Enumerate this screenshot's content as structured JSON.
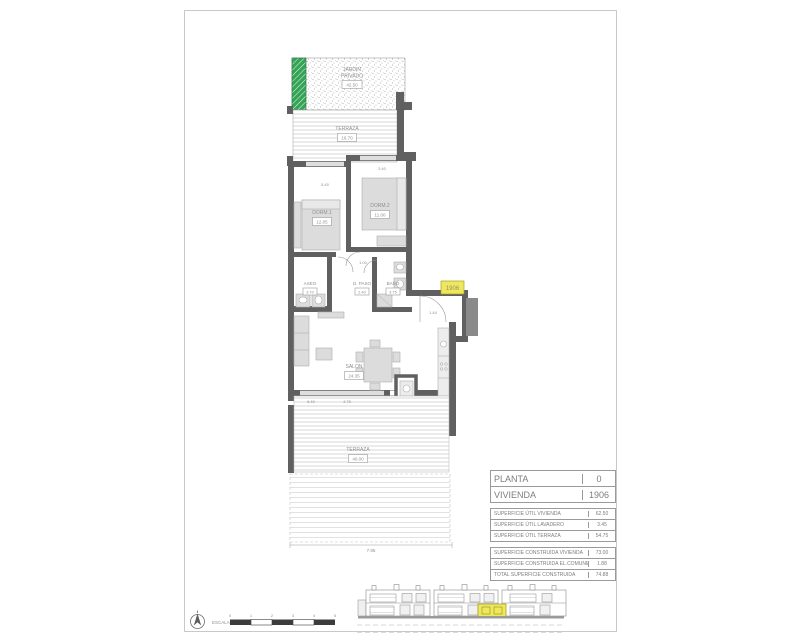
{
  "plan": {
    "jardin": {
      "line1": "JARDIN",
      "line2": "PRIVADO",
      "value": "42.50"
    },
    "terraza_top": {
      "label": "TERRAZA",
      "value": "16.70"
    },
    "dorm1": {
      "label": "DORM.1",
      "value": "12.05"
    },
    "dorm2": {
      "label": "DORM.2",
      "value": "11.00"
    },
    "aseo": {
      "label": "ASEO",
      "value": "3.70"
    },
    "paso": {
      "label": "D. PASO",
      "value": "2.40"
    },
    "bano": {
      "label": "BAÑO",
      "value": "3.75"
    },
    "salon": {
      "label": "SALON",
      "value": "24.35"
    },
    "lav": {
      "label": "LAV.",
      "value": "3.45"
    },
    "terraza_bottom": {
      "label": "TERRAZA",
      "value": "40.00"
    },
    "unit_tag": "1906",
    "dims": {
      "d1": "5.45",
      "d2": "3.40",
      "d3": "1.00",
      "d4": "1.44",
      "d5": "6.40",
      "d6": "4.75",
      "d7": "7.95"
    }
  },
  "titleblock": {
    "main": [
      {
        "label": "PLANTA",
        "value": "0"
      },
      {
        "label": "VIVIENDA",
        "value": "1906"
      }
    ],
    "utiles": [
      {
        "label": "SUPERFICIE ÚTIL VIVIENDA",
        "value": "62.50"
      },
      {
        "label": "SUPERFICIE ÚTIL LAVADERO",
        "value": "3.45"
      },
      {
        "label": "SUPERFICIE ÚTIL TERRAZA",
        "value": "54.75"
      }
    ],
    "construidas": [
      {
        "label": "SUPERFICIE CONSTRUIDA VIVIENDA",
        "value": "73.00"
      },
      {
        "label": "SUPERFICIE CONSTRUIDA EL.COMUNES",
        "value": "1.88"
      },
      {
        "label": "TOTAL SUPERFICIE CONSTRUIDA",
        "value": "74.88"
      }
    ]
  },
  "scale": {
    "label": "ESCALA :",
    "ticks": [
      "0",
      "1",
      "2",
      "3",
      "4",
      "5"
    ]
  },
  "colors": {
    "wall": "#606060",
    "green": "#35a457",
    "highlight": "#efe95a"
  }
}
